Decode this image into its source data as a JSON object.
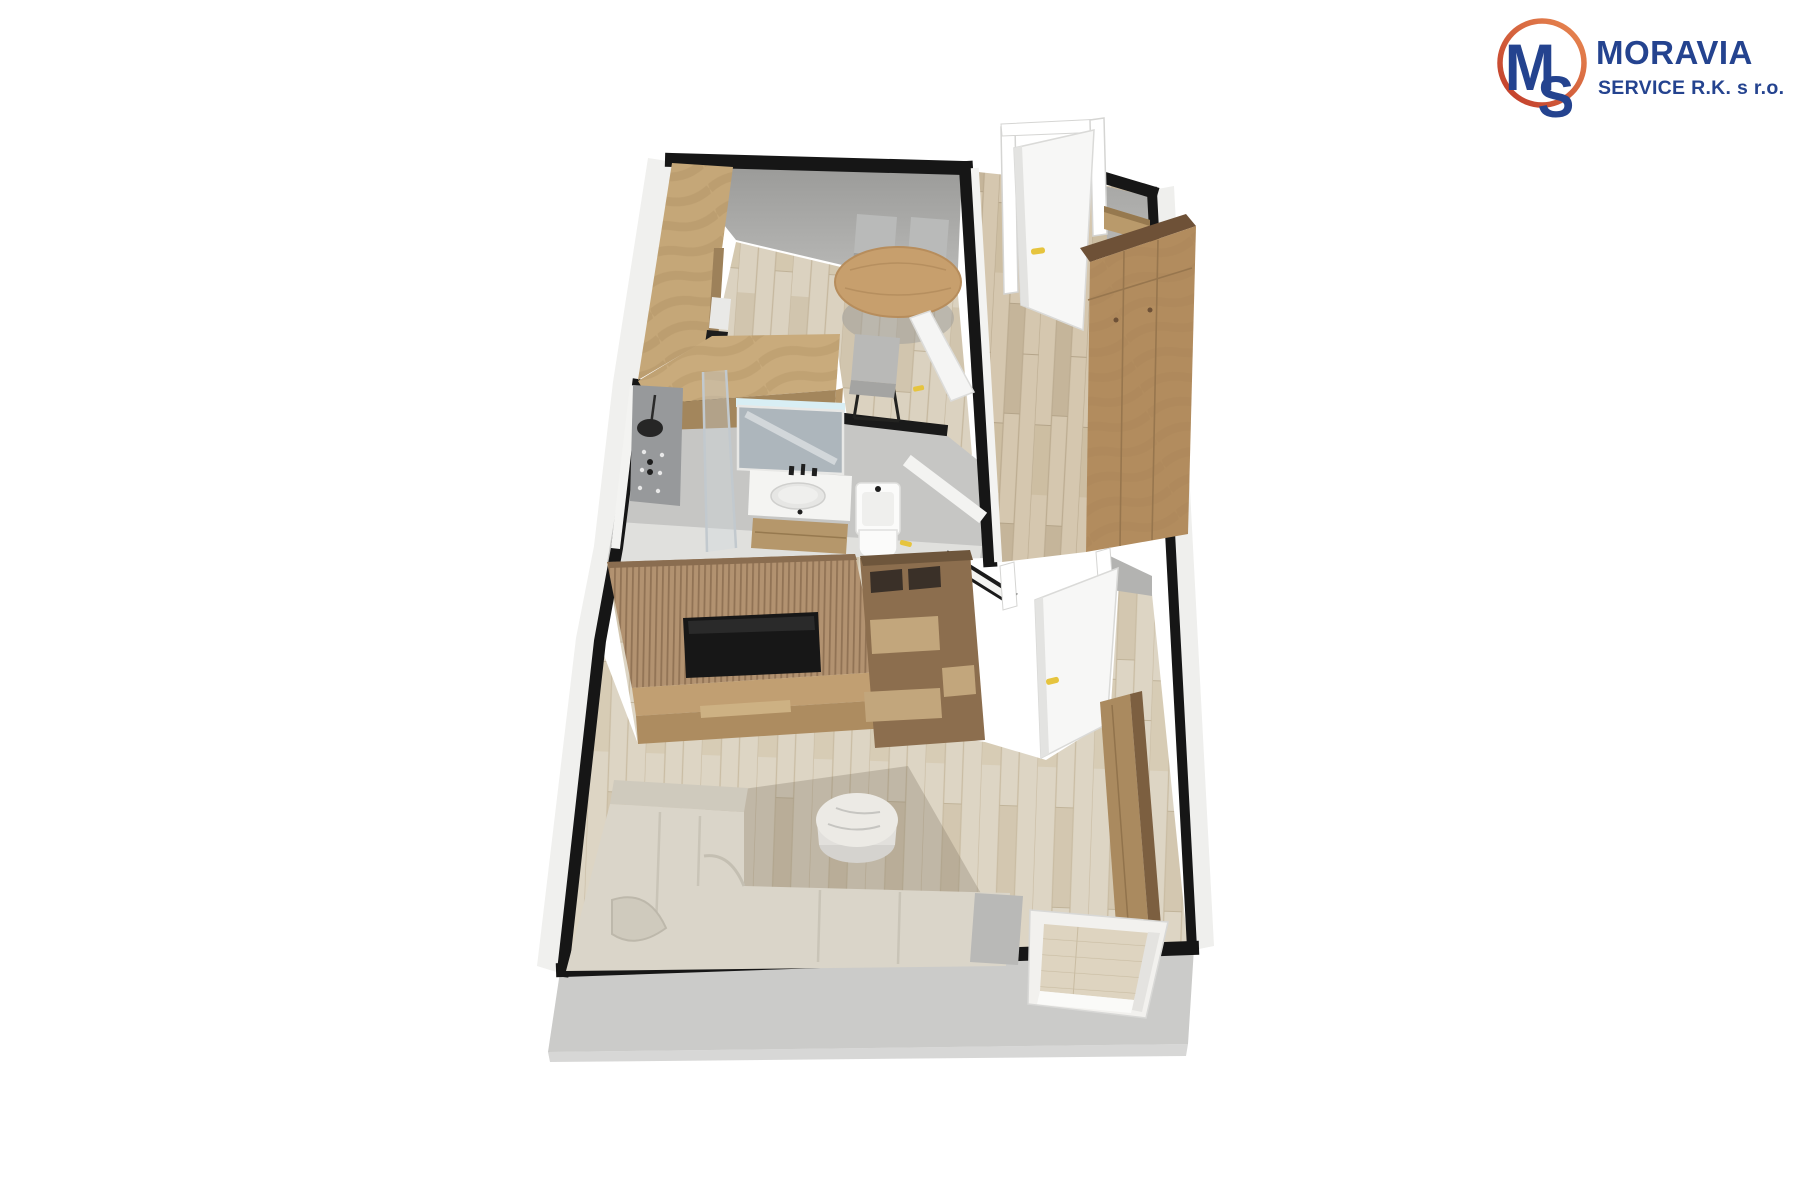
{
  "logo": {
    "monogram_m": "M",
    "monogram_s": "S",
    "brand": "MORAVIA",
    "subtitle": "SERVICE R.K. s r.o."
  },
  "colors": {
    "brand_blue": "#24438f",
    "ring_red": "#c03a29",
    "ring_orange": "#e98a52",
    "wall_black": "#161616",
    "slab_gray": "#cbcbc9",
    "wall_face_gray": "#a9a9a7",
    "wood_counter": "#c5a778",
    "wood_floor_kitchen": "#dbd2c0",
    "wood_floor_hall": "#d5c7af",
    "wood_floor_living": "#ddd5c4",
    "wood_wardrobe": "#b28c5e",
    "wood_slat_wall": "#b29270",
    "tv_black": "#171717",
    "sofa_beige": "#dad5c9",
    "rug_taupe": "#8f8272",
    "door_white": "#f7f7f6",
    "handle_yellow": "#e6c43e",
    "fixture_white": "#fafafa",
    "table_wood": "#c79f6d",
    "chair_gray": "#b9bab9"
  },
  "scene": {
    "render_type": "3d-floorplan",
    "areas": [
      "kitchen-dining",
      "bathroom",
      "hallway",
      "living-room",
      "balcony"
    ]
  }
}
